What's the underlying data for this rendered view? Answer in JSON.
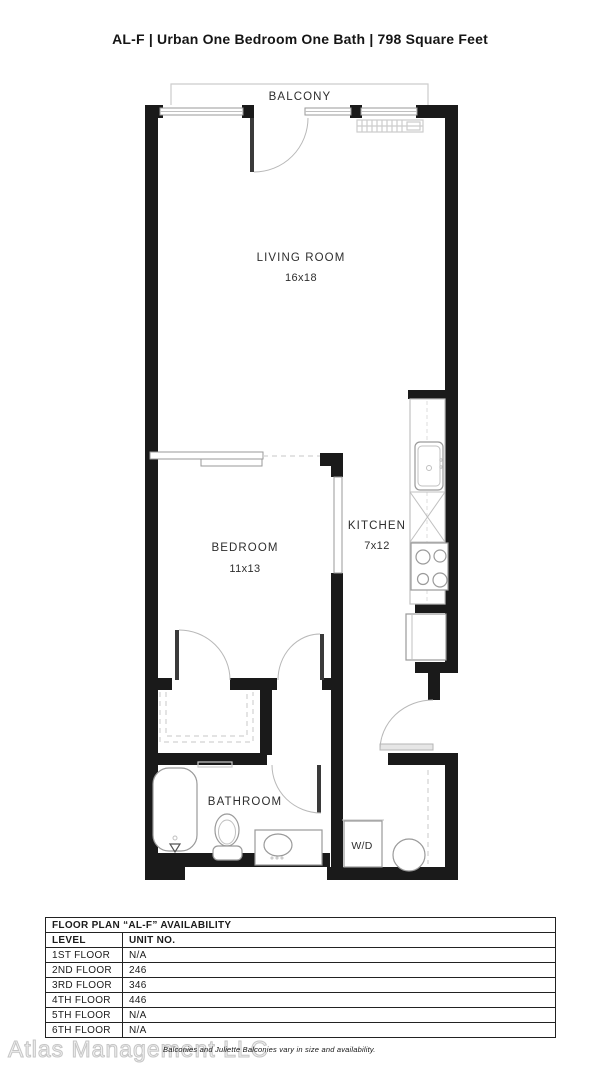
{
  "title": "AL-F | Urban One Bedroom One Bath | 798 Square Feet",
  "plan": {
    "balcony_label": "BALCONY",
    "living_room": {
      "name": "LIVING ROOM",
      "dims": "16x18"
    },
    "bedroom": {
      "name": "BEDROOM",
      "dims": "11x13"
    },
    "kitchen": {
      "name": "KITCHEN",
      "dims": "7x12"
    },
    "bathroom_label": "BATHROOM",
    "washer_dryer_label": "W/D"
  },
  "availability_table": {
    "title": "FLOOR PLAN “AL-F” AVAILABILITY",
    "columns": {
      "level": "LEVEL",
      "unit": "UNIT NO."
    },
    "rows": [
      {
        "level": "1ST FLOOR",
        "unit": "N/A"
      },
      {
        "level": "2ND FLOOR",
        "unit": "246"
      },
      {
        "level": "3RD FLOOR",
        "unit": "346"
      },
      {
        "level": "4TH FLOOR",
        "unit": "446"
      },
      {
        "level": "5TH FLOOR",
        "unit": "N/A"
      },
      {
        "level": "6TH FLOOR",
        "unit": "N/A"
      }
    ]
  },
  "footer": {
    "watermark": "Atlas Management LLC",
    "disclaimer": "Balconies and Juliette Balconies vary in size and availability."
  },
  "colors": {
    "wall": "#1a1a1a",
    "fixture_outline": "#9a9a9a",
    "light_outline": "#cccccc"
  }
}
